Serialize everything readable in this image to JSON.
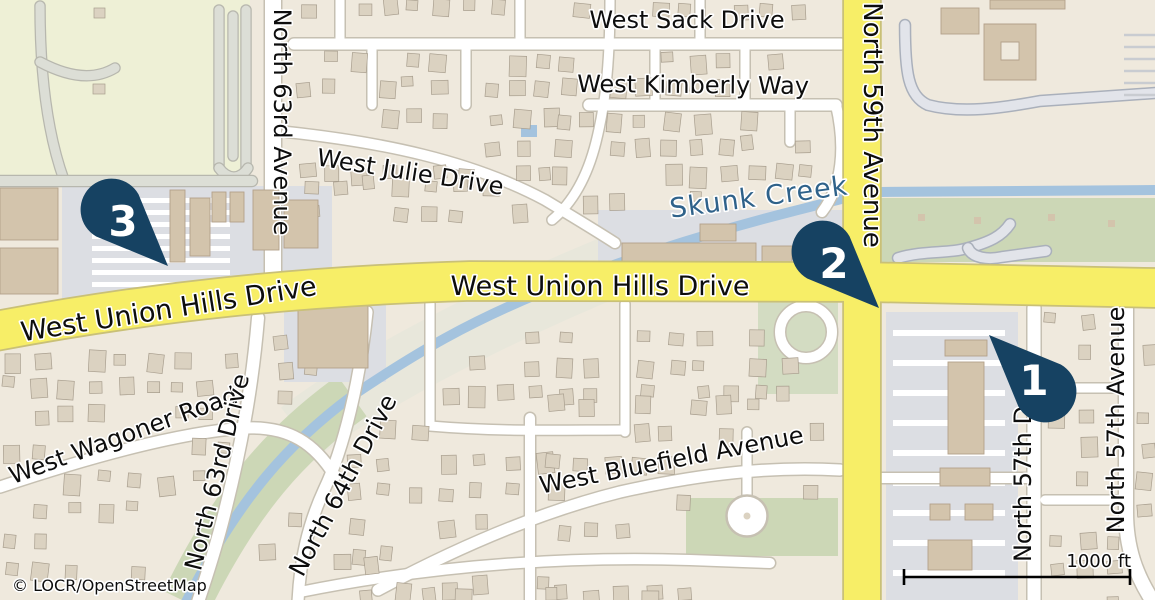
{
  "attribution": {
    "text": "© LOCR/OpenStreetMap"
  },
  "scale_bar": {
    "label": "1000 ft"
  },
  "markers": {
    "m1": {
      "label": "1"
    },
    "m2": {
      "label": "2"
    },
    "m3": {
      "label": "3"
    }
  },
  "street_labels": {
    "west_sack_drive": "West Sack Drive",
    "west_kimberly_way": "West Kimberly Way",
    "west_julie_drive": "West Julie Drive",
    "north_63rd_avenue": "North 63rd Avenue",
    "north_59th_avenue": "North 59th Avenue",
    "west_union_hills_drive_west": "West Union Hills Drive",
    "west_union_hills_drive_center": "West Union Hills Drive",
    "west_wagoner_road": "West Wagoner Road",
    "north_63rd_drive": "North 63rd Drive",
    "north_64th_drive": "North 64th Drive",
    "west_bluefield_avenue": "West Bluefield Avenue",
    "north_57th_drive": "North 57th D",
    "north_57th_avenue": "North 57th Avenue"
  },
  "water_labels": {
    "skunk_creek": "Skunk Creek"
  },
  "colors": {
    "residential": "#efe9dd",
    "field": "#eef0d6",
    "green": "#ccd7b6",
    "green_muted": "#d3dcc2",
    "swath": "#e8e7db",
    "water": "#a4c3de",
    "water_label": "#2f628a",
    "road_yellow": "#f7ee67",
    "road_yellow_casing": "#c9c077",
    "road_white": "#ffffff",
    "road_casing": "#c6c0b2",
    "service_fill": "#e2e4ea",
    "service_casing": "#aab0bb",
    "parking": "#dcdee3",
    "field_road": "#dcded6",
    "field_road_casing": "#b7b7ae",
    "building": "#dbd2c1",
    "building_stroke": "#a89e8e",
    "building_tan": "#d3c4ac",
    "building_tan_stroke": "#b3a18a",
    "label_text": "#0d0d0d",
    "marker": "#164262"
  }
}
